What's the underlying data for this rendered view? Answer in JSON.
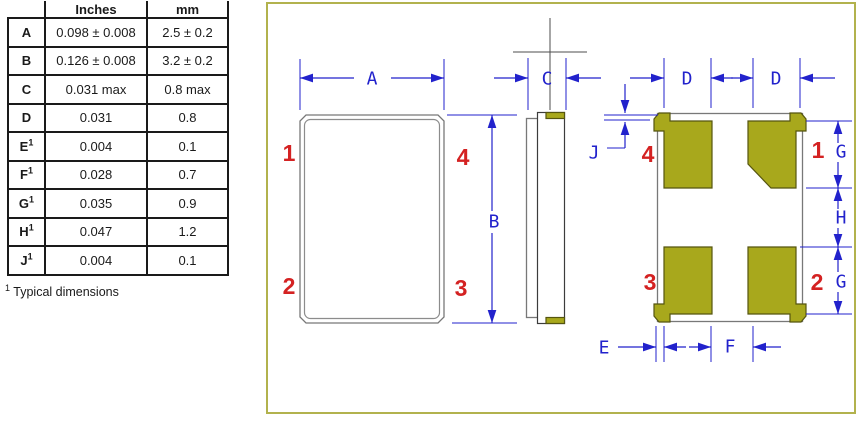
{
  "table": {
    "headers": {
      "dim": "",
      "inches": "Inches",
      "mm": "mm"
    },
    "rows": [
      {
        "label": "A",
        "sup": "",
        "inches": "0.098 ± 0.008",
        "mm": "2.5 ± 0.2"
      },
      {
        "label": "B",
        "sup": "",
        "inches": "0.126 ± 0.008",
        "mm": "3.2 ± 0.2"
      },
      {
        "label": "C",
        "sup": "",
        "inches": "0.031 max",
        "mm": "0.8 max"
      },
      {
        "label": "D",
        "sup": "",
        "inches": "0.031",
        "mm": "0.8"
      },
      {
        "label": "E",
        "sup": "1",
        "inches": "0.004",
        "mm": "0.1"
      },
      {
        "label": "F",
        "sup": "1",
        "inches": "0.028",
        "mm": "0.7"
      },
      {
        "label": "G",
        "sup": "1",
        "inches": "0.035",
        "mm": "0.9"
      },
      {
        "label": "H",
        "sup": "1",
        "inches": "0.047",
        "mm": "1.2"
      },
      {
        "label": "J",
        "sup": "1",
        "inches": "0.004",
        "mm": "0.1"
      }
    ],
    "footnote": {
      "sup": "1",
      "text": " Typical dimensions"
    }
  },
  "drawing": {
    "front_pins": {
      "top_left": "1",
      "top_right": "4",
      "bottom_left": "2",
      "bottom_right": "3"
    },
    "back_pins": {
      "top_left": "4",
      "top_right": "1",
      "bottom_left": "3",
      "bottom_right": "2"
    },
    "dims": {
      "a": "A",
      "b": "B",
      "c": "C",
      "d_left": "D",
      "d_right": "D",
      "e": "E",
      "f": "F",
      "g_top": "G",
      "h": "H",
      "g_bottom": "G",
      "j": "J"
    },
    "colors": {
      "dimension_blue": "#2222cc",
      "pin_label_red": "#d42222",
      "pad_olive": "#a8a81c",
      "outline_gray": "#808080",
      "frame_border_olive": "#b2b24d"
    }
  }
}
